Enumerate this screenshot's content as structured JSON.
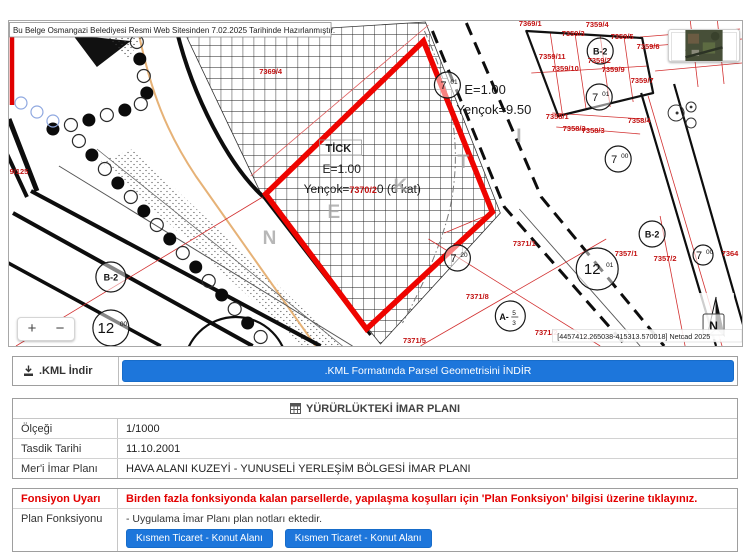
{
  "map": {
    "disclaimer": "Bu Belge Osmangazi Belediyesi Resmi Web Sitesinden 7.02.2025 Tarihinde Hazırlanmıştır.",
    "coordinates": "[4457412.265038-415313.570018] Netcad 2025",
    "north_label": "N",
    "zoom_in_label": "+",
    "zoom_out_label": "−",
    "selected_parcel": {
      "zone_code": "TİCK",
      "far": "E=1.00",
      "height_prefix": "Yençok=",
      "parcel_no_overlay": "7370/2",
      "height_suffix": "0 (6 kat)"
    },
    "road_labels": {
      "far": "E=1.00",
      "yencok": "Yençok=9.50"
    },
    "parcel_labels": [
      {
        "t": "7369/4",
        "x": 270,
        "y": 73
      },
      {
        "t": "7369/1",
        "x": 530,
        "y": 25
      },
      {
        "t": "7359/4",
        "x": 597,
        "y": 26
      },
      {
        "t": "7359/3",
        "x": 573,
        "y": 35
      },
      {
        "t": "7359/5",
        "x": 622,
        "y": 38
      },
      {
        "t": "7359/6",
        "x": 648,
        "y": 48
      },
      {
        "t": "7359/11",
        "x": 552,
        "y": 58
      },
      {
        "t": "7359/2",
        "x": 599,
        "y": 62
      },
      {
        "t": "7359/10",
        "x": 565,
        "y": 70
      },
      {
        "t": "7359/9",
        "x": 613,
        "y": 71
      },
      {
        "t": "7359/7",
        "x": 642,
        "y": 82
      },
      {
        "t": "7367/1",
        "x": 695,
        "y": 57
      },
      {
        "t": "7367/2",
        "x": 721,
        "y": 55
      },
      {
        "t": "7358/1",
        "x": 557,
        "y": 118
      },
      {
        "t": "7358/2",
        "x": 574,
        "y": 130
      },
      {
        "t": "7358/3",
        "x": 593,
        "y": 132
      },
      {
        "t": "7358/4",
        "x": 639,
        "y": 122
      },
      {
        "t": "7371/1",
        "x": 524,
        "y": 245
      },
      {
        "t": "7371/8",
        "x": 477,
        "y": 298
      },
      {
        "t": "7371/2",
        "x": 546,
        "y": 334
      },
      {
        "t": "7371/5",
        "x": 414,
        "y": 342
      },
      {
        "t": "7357/1",
        "x": 626,
        "y": 255
      },
      {
        "t": "7357/2",
        "x": 665,
        "y": 260
      },
      {
        "t": "7364",
        "x": 730,
        "y": 255
      },
      {
        "t": "9/125",
        "x": 18,
        "y": 173
      }
    ],
    "circle_labels": [
      {
        "x": 447,
        "y": 84,
        "r": 13,
        "text": "7",
        "sup": "01"
      },
      {
        "x": 599,
        "y": 96,
        "r": 13,
        "text": "7",
        "sup": "01"
      },
      {
        "x": 618,
        "y": 158,
        "r": 13,
        "text": "7",
        "sup": "00"
      },
      {
        "x": 457,
        "y": 257,
        "r": 13,
        "text": "7",
        "sup": "20"
      },
      {
        "x": 597,
        "y": 268,
        "r": 21,
        "text": "12",
        "sup": "01"
      },
      {
        "x": 110,
        "y": 327,
        "r": 18,
        "text": "12",
        "sup": "00"
      },
      {
        "x": 110,
        "y": 276,
        "r": 15,
        "text": "B-2"
      },
      {
        "x": 600,
        "y": 50,
        "r": 13,
        "text": "B-2"
      },
      {
        "x": 652,
        "y": 233,
        "r": 13,
        "text": "B-2"
      },
      {
        "x": 703,
        "y": 254,
        "r": 10,
        "text": "7",
        "sup": "00"
      },
      {
        "x": 510,
        "y": 315,
        "r": 15,
        "text": "A-",
        "frac_top": "5",
        "frac_bottom": "3"
      }
    ],
    "street_letters": [
      {
        "t": "N",
        "x": 262,
        "y": 243
      },
      {
        "t": "E",
        "x": 327,
        "y": 217
      },
      {
        "t": "K",
        "x": 393,
        "y": 191
      },
      {
        "t": "T",
        "x": 457,
        "y": 167
      },
      {
        "t": "I",
        "x": 516,
        "y": 141
      }
    ]
  },
  "kml": {
    "label": ".KML İndir",
    "button": ".KML Formatında Parsel Geometrisini İNDİR"
  },
  "plan_table": {
    "title": "YÜRÜRLÜKTEKİ İMAR PLANI",
    "rows": [
      {
        "label": "Ölçeği",
        "value": "1/1000"
      },
      {
        "label": "Tasdik Tarihi",
        "value": "11.10.2001"
      },
      {
        "label": "Mer'i İmar Planı",
        "value": "HAVA ALANI KUZEYİ - YUNUSELİ YERLEŞİM BÖLGESİ İMAR PLANI"
      }
    ]
  },
  "function_table": {
    "warning_label": "Fonsiyon Uyarı",
    "warning_text": "Birden fazla fonksiyonda kalan parsellerde, yapılaşma koşulları için 'Plan Fonksiyon' bilgisi üzerine tıklayınız.",
    "function_label": "Plan Fonksiyonu",
    "note": "- Uygulama İmar Planı plan notları ektedir.",
    "buttons": [
      "Kısmen Ticaret - Konut Alanı",
      "Kısmen Ticaret - Konut Alanı"
    ]
  },
  "colors": {
    "accent_blue": "#1d76db",
    "warning_red": "#e30000",
    "selected_parcel_red": "#ee0400",
    "cadastral_label_red": "#c21212"
  }
}
